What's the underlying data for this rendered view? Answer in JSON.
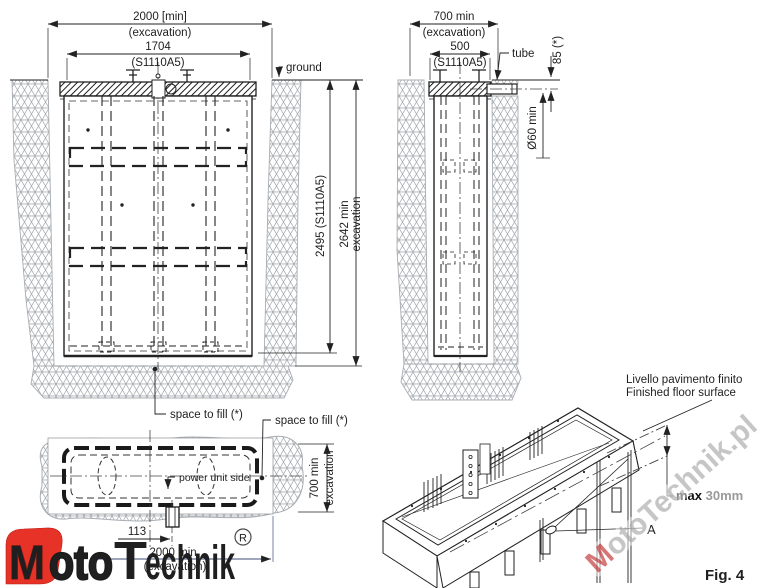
{
  "colors": {
    "line": "#222222",
    "soil": "#a8adb2",
    "logo_red": "#e73228",
    "logo_dark": "#3d3d3d",
    "watermark_gray": "#b8b8b8",
    "watermark_red": "#cd5454",
    "hidden_dim_blue": "#3f4e7a"
  },
  "front_view": {
    "dim_excavation_width": "2000 [min]",
    "dim_excavation_width_sub": "(excavation)",
    "dim_unit_width": "1704",
    "dim_unit_width_sub": "(S1110A5)",
    "ground_label": "ground",
    "dim_unit_depth": "2495 (S1110A5)",
    "dim_excavation_depth": "2642 min",
    "dim_excavation_depth_sub": "excavation",
    "space_to_fill_label": "space to fill (*)"
  },
  "side_view": {
    "dim_excavation_width": "700 min",
    "dim_excavation_width_sub": "(excavation)",
    "dim_unit_width": "500",
    "dim_unit_width_sub": "(S1110A5)",
    "tube_label": "tube",
    "dim_tube_depth": "85 (*)",
    "dim_tube_diameter": "Ø60 min"
  },
  "top_view": {
    "space_to_fill_label": "space to fill (*)",
    "power_unit_label": "power unit side",
    "dim_excavation_depth": "700 min",
    "dim_excavation_depth_sub": "excavation",
    "dim_offset": "113",
    "dim_excavation_width": "2000 min",
    "dim_excavation_width_sub": "(excavation)"
  },
  "iso_view": {
    "floor_label_line1": "Livello pavimento finito",
    "floor_label_line2": "Finished floor surface",
    "max_gap_label": "max ",
    "max_gap_value": "30mm",
    "detail_label": "A"
  },
  "figure_label": "Fig. 4",
  "logo": {
    "m": "M",
    "oto": "oto",
    "t": "T",
    "echnik": "echnik",
    "registered": "R"
  },
  "watermark": {
    "m": "M",
    "rest": "otoTechnik.pl"
  }
}
